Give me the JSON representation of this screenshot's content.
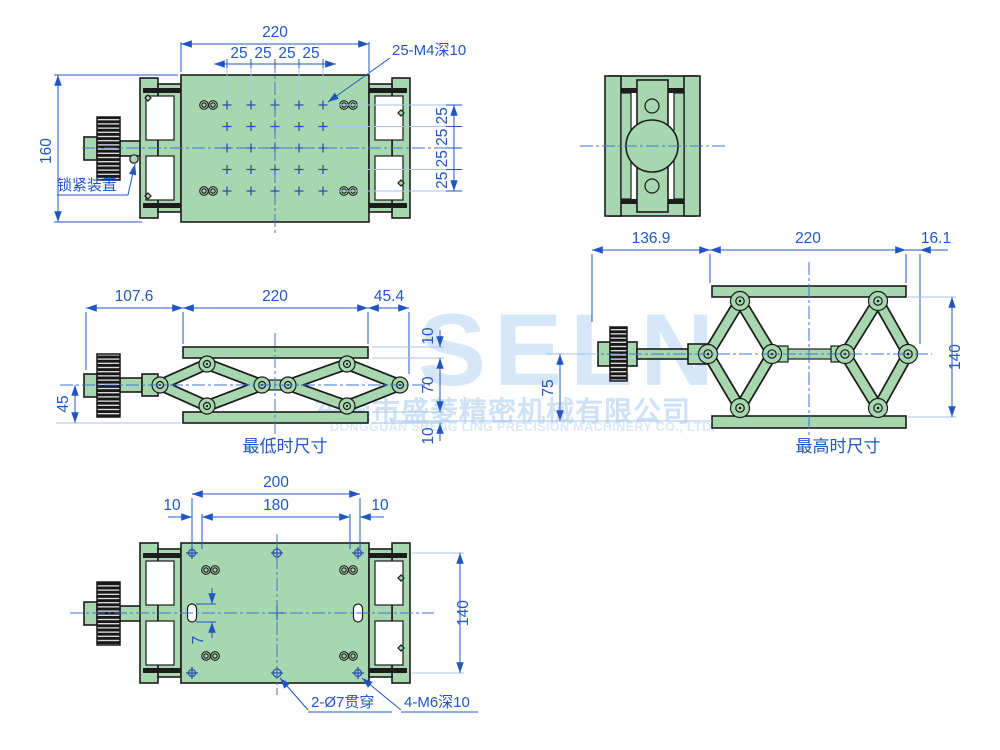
{
  "watermark": {
    "brand": "SELN",
    "company_cn": "东莞市盛菱精密机械有限公司",
    "company_en": "DONGGUAN SHENG LING PRECISION MACHINERY CO., LTD."
  },
  "colors": {
    "part_fill": "#a7d7af",
    "part_outline": "#1c1c1c",
    "dimension": "#2056c4",
    "centerline": "#3f74d0",
    "light_line": "#a4c6e8",
    "watermark_text": "#d5e7f8",
    "background": "#ffffff"
  },
  "views": {
    "top": {
      "dim_width": "220",
      "pitch": [
        "25",
        "25",
        "25",
        "25"
      ],
      "dim_height": "160",
      "side_pitch": [
        "25",
        "25",
        "25",
        "25"
      ],
      "callout_holes": "25-M4深10",
      "callout_lock": "锁紧装置"
    },
    "lowest": {
      "label": "最低时尺寸",
      "dim_left": "107.6",
      "dim_mid": "220",
      "dim_right": "45.4",
      "dim_center_height": "45",
      "dim_top_plate": "10",
      "dim_span": "70",
      "dim_bottom_plate": "10"
    },
    "highest": {
      "label": "最高时尺寸",
      "dim_left": "136.9",
      "dim_mid": "220",
      "dim_right": "16.1",
      "dim_center_height": "75",
      "dim_height": "140"
    },
    "bottom": {
      "dim_outer": "200",
      "dim_inner": "180",
      "dim_offset_left": "10",
      "dim_offset_right": "10",
      "dim_slot": "7",
      "dim_height": "140",
      "callout_through": "2-Ø7贯穿",
      "callout_tapped": "4-M6深10"
    }
  }
}
